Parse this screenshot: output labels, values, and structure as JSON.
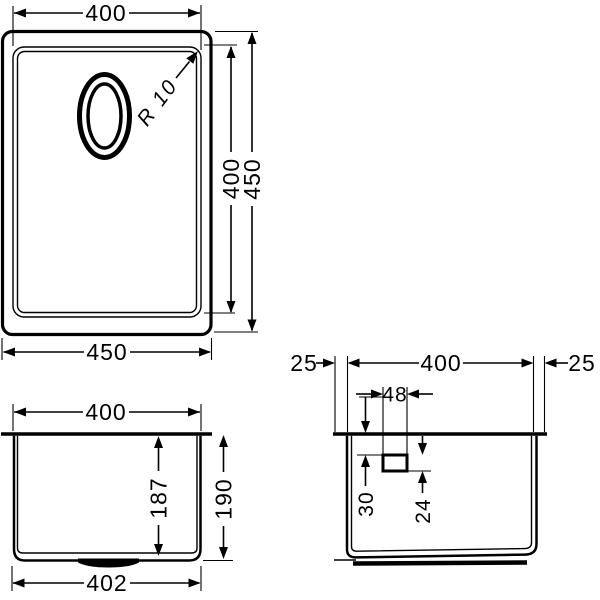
{
  "drawing": {
    "background_color": "#ffffff",
    "line_color": "#000000",
    "top_view": {
      "width_top": "400",
      "height_inner": "400",
      "height_outer": "450",
      "width_bottom": "450",
      "corner_radius": "R 10"
    },
    "front_view": {
      "width_top": "400",
      "depth_inner": "187",
      "depth_outer": "190",
      "width_bottom": "402"
    },
    "side_view": {
      "offset_left": "25",
      "width": "400",
      "offset_right": "25",
      "drain_width": "48",
      "drain_top_offset": "30",
      "drain_height": "24"
    }
  }
}
